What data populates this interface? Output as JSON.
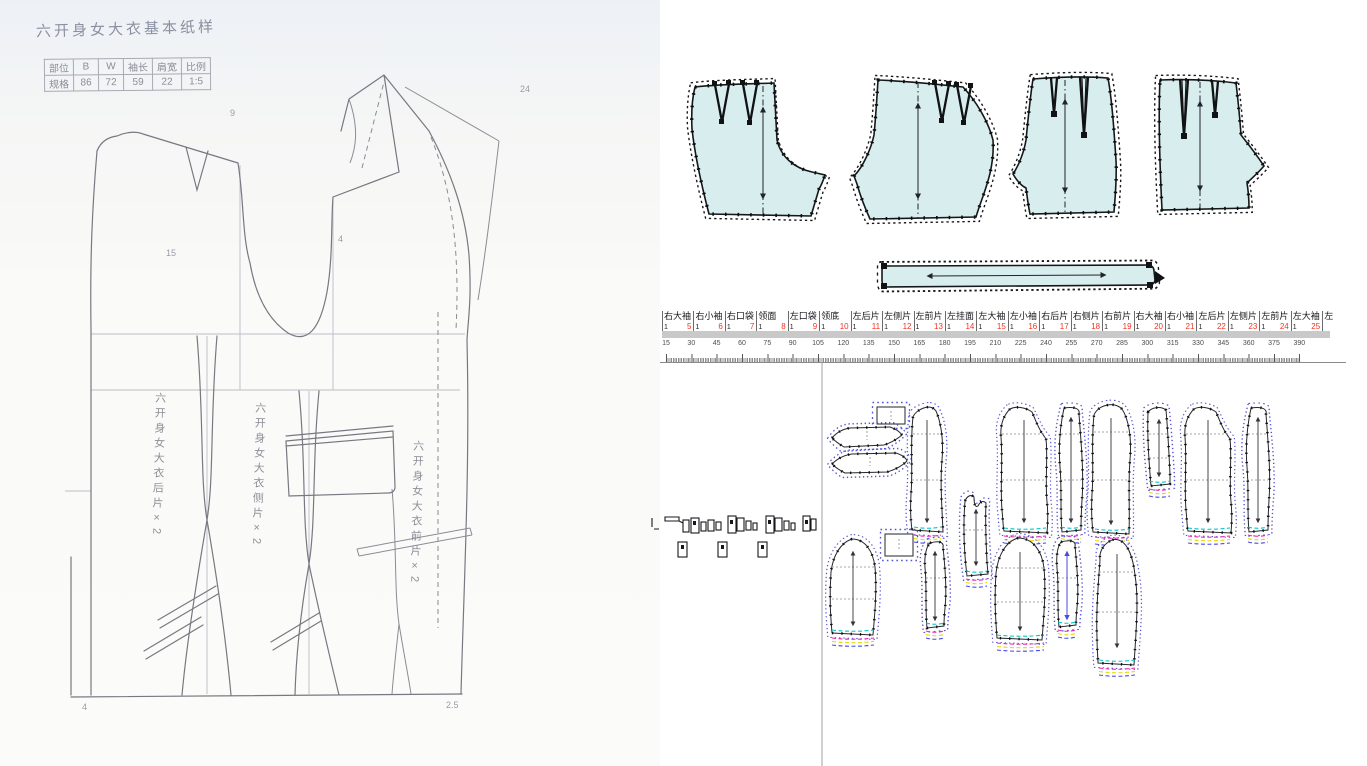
{
  "sketch": {
    "title": "六开身女大衣基本纸样",
    "spec_table": {
      "headers": [
        "部位",
        "B",
        "W",
        "袖长",
        "肩宽",
        "比例"
      ],
      "row_label": "规格",
      "values": [
        "86",
        "72",
        "59",
        "22",
        "1:5"
      ]
    },
    "panel_labels": [
      "六开身女大衣后片×2",
      "六开身女大衣侧片×2",
      "六开身女大衣前片×2"
    ],
    "notes": [
      "9",
      "4",
      "15",
      "4",
      "2.5",
      "24"
    ]
  },
  "cad": {
    "piece_tabs": [
      {
        "name": "右大袖",
        "count": "1",
        "num": "5"
      },
      {
        "name": "右小袖",
        "count": "1",
        "num": "6"
      },
      {
        "name": "右口袋",
        "count": "1",
        "num": "7"
      },
      {
        "name": "领面",
        "count": "1",
        "num": "8"
      },
      {
        "name": "左口袋",
        "count": "1",
        "num": "9"
      },
      {
        "name": "领底",
        "count": "1",
        "num": "10"
      },
      {
        "name": "左后片",
        "count": "1",
        "num": "11"
      },
      {
        "name": "左侧片",
        "count": "1",
        "num": "12"
      },
      {
        "name": "左前片",
        "count": "1",
        "num": "13"
      },
      {
        "name": "左挂面",
        "count": "1",
        "num": "14"
      },
      {
        "name": "左大袖",
        "count": "1",
        "num": "15"
      },
      {
        "name": "左小袖",
        "count": "1",
        "num": "16"
      },
      {
        "name": "右后片",
        "count": "1",
        "num": "17"
      },
      {
        "name": "右侧片",
        "count": "1",
        "num": "18"
      },
      {
        "name": "右前片",
        "count": "1",
        "num": "19"
      },
      {
        "name": "右大袖",
        "count": "1",
        "num": "20"
      },
      {
        "name": "右小袖",
        "count": "1",
        "num": "21"
      },
      {
        "name": "左后片",
        "count": "1",
        "num": "22"
      },
      {
        "name": "左侧片",
        "count": "1",
        "num": "23"
      },
      {
        "name": "左前片",
        "count": "1",
        "num": "24"
      },
      {
        "name": "左大袖",
        "count": "1",
        "num": "25"
      }
    ],
    "partial_tab": "左",
    "ruler_ticks": [
      15,
      30,
      45,
      60,
      75,
      90,
      105,
      120,
      135,
      150,
      165,
      180,
      195,
      210,
      225,
      240,
      255,
      270,
      285,
      300,
      315,
      330,
      345,
      360,
      375,
      390
    ],
    "colors": {
      "piece_fill": "#d8edee",
      "outline": "#15181a",
      "tab_number_red": "#f33221",
      "grade_cyan": "#00c8c8",
      "grade_magenta": "#e828b8",
      "grade_yellow": "#e8d800",
      "grade_blue": "#4848e8",
      "dotted_outline_blue": "#5353d6"
    }
  }
}
